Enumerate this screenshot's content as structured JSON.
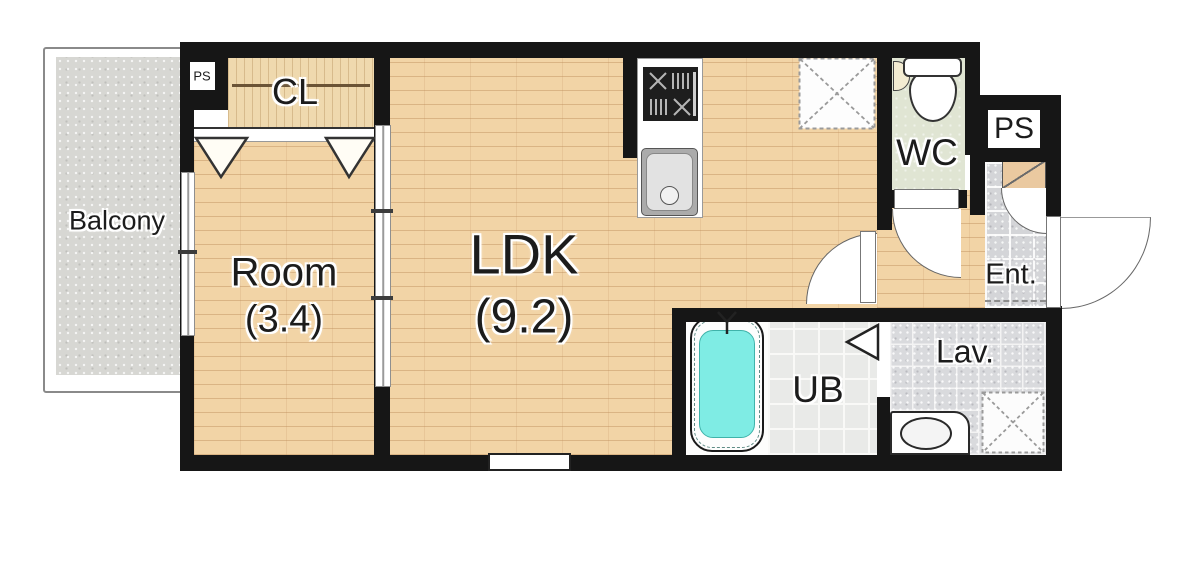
{
  "labels": {
    "balcony": "Balcony",
    "ps_top_left": "PS",
    "closet": "CL",
    "room": "Room",
    "room_area": "(3.4)",
    "ldk": "LDK",
    "ldk_area": "(9.2)",
    "wc": "WC",
    "ps_right": "PS",
    "entrance": "Ent.",
    "lavatory": "Lav.",
    "unit_bath": "UB"
  },
  "colors": {
    "wall": "#161616",
    "wood_floor": "#f2d4a6",
    "closet_wood": "#efd9ae",
    "balcony_concrete": "#d7d7d3",
    "wc_floor": "#e0e5d3",
    "entrance_tile": "#d4d5d8",
    "lavatory_tile": "#d9dadd",
    "bath_tile": "#e9eae8",
    "bath_water": "#7fece4",
    "shoe_cabinet": "#eac9a0"
  },
  "fixtures": {
    "kitchen": [
      "stove",
      "sink"
    ],
    "wc": [
      "toilet"
    ],
    "unit_bath": [
      "bathtub",
      "folding-door"
    ],
    "lavatory": [
      "washbasin",
      "washing-machine-space"
    ],
    "ldk": [
      "refrigerator-space"
    ],
    "entrance": [
      "shoe-cabinet",
      "front-door"
    ]
  }
}
